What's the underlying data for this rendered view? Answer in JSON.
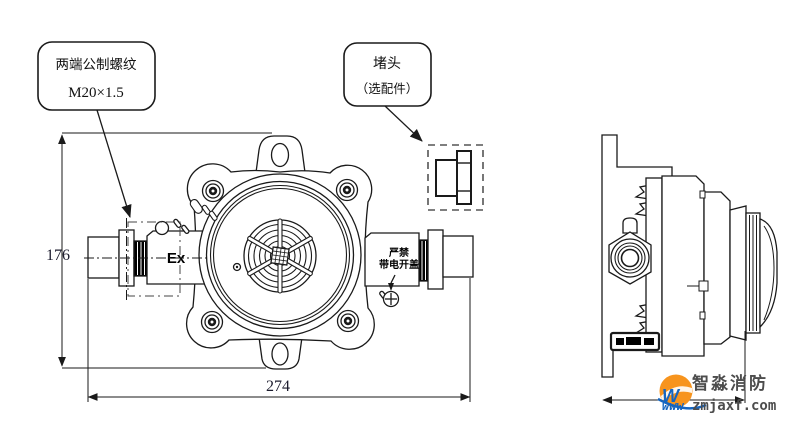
{
  "drawing": {
    "title_hint": "explosion-proof junction box two-view technical drawing",
    "callouts": {
      "thread": {
        "line1": "两端公制螺纹",
        "line2": "M20×1.5"
      },
      "plug": {
        "line1": "堵头",
        "line2": "（选配件）"
      }
    },
    "dimensions": {
      "front_height": "176",
      "front_width": "274"
    },
    "front_view": {
      "ex_mark": "Ex",
      "warning_line1": "严禁",
      "warning_line2": "带电开盖"
    }
  },
  "watermark": {
    "brand": "智淼消防",
    "url_prefix": "www",
    "url": "zmjaxf.com",
    "logo_orange": "#f7941d",
    "logo_blue": "#1565c0",
    "text_color": "#4d4d4d"
  },
  "colors": {
    "line": "#1a1a1a",
    "dashed_box": "#555555",
    "dim_text": "#1c1c2e"
  }
}
